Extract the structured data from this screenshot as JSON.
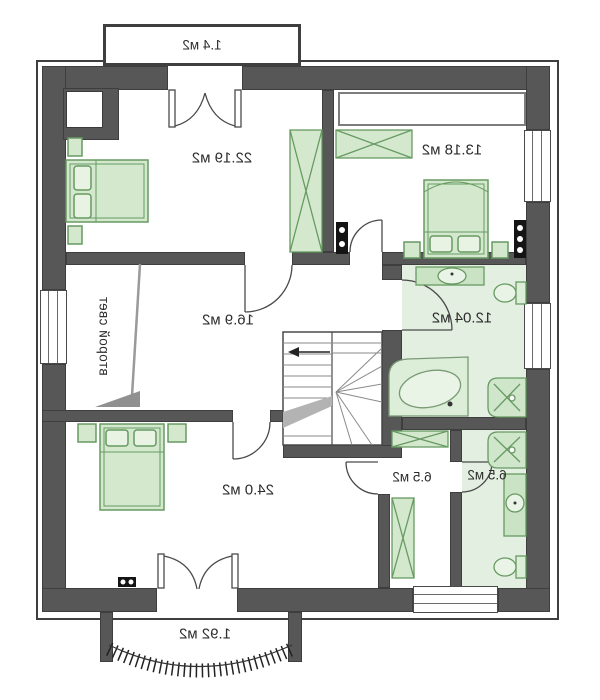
{
  "plan_type": "floor-plan",
  "labels": {
    "balcony_top": "1.4 м2",
    "bedroom_top_left": "22.19 м2",
    "bedroom_top_right": "13.18 м2",
    "second_light": "второй свет",
    "hall": "16.9 м2",
    "bathroom": "12.04 м2",
    "bedroom_bottom": "24.0 м2",
    "dressing": "6.5 м2",
    "wc": "6.5 м2",
    "balcony_bottom": "1.92 м2"
  },
  "colors": {
    "wall": "#575757",
    "wall_outline": "#3e3e3e",
    "furniture_fill": "#d3e8cd",
    "furniture_stroke": "#679a62",
    "floor_green": "#e3efe0",
    "text": "#2d2d2d"
  }
}
